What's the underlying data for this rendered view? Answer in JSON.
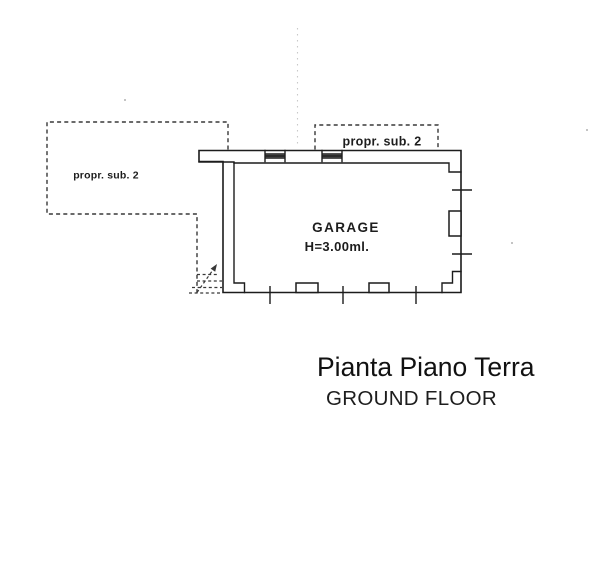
{
  "floor_plan": {
    "areas": {
      "left_property_label": "propr. sub. 2",
      "top_property_label": "propr. sub. 2",
      "room_label": "GARAGE",
      "room_height_label": "H=3.00ml."
    },
    "caption": {
      "title": "Pianta Piano Terra",
      "subtitle": "GROUND FLOOR"
    },
    "colors": {
      "ink": "#1c1c1c",
      "dashed_ink": "#383838",
      "subtitle_red": "#e01f1f",
      "fold_line_gray": "#c9c9c9",
      "paper": "#ffffff"
    }
  }
}
